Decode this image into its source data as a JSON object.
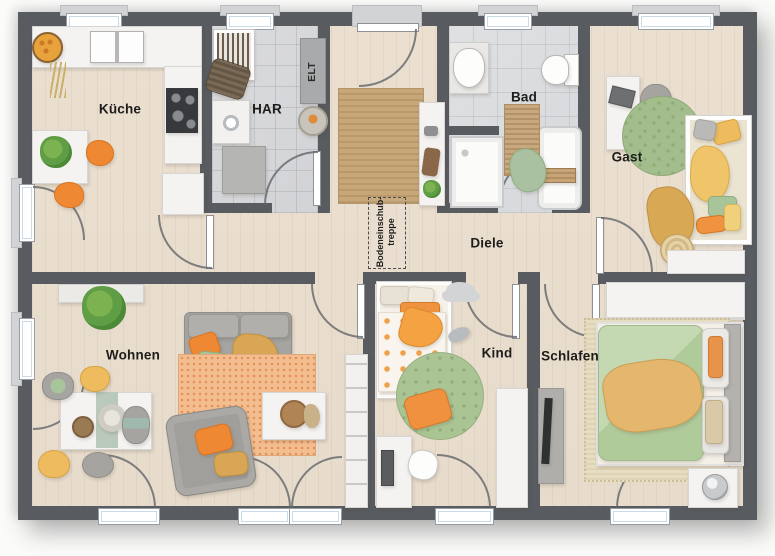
{
  "plan": {
    "type": "floor-plan",
    "rooms": {
      "kueche": {
        "label": "Küche"
      },
      "har": {
        "label": "HAR"
      },
      "elt": {
        "label": "ELT"
      },
      "bad": {
        "label": "Bad"
      },
      "gast": {
        "label": "Gast"
      },
      "diele": {
        "label": "Diele"
      },
      "wohnen": {
        "label": "Wohnen"
      },
      "kind": {
        "label": "Kind"
      },
      "schlafen": {
        "label": "Schlafen"
      }
    },
    "annotations": {
      "loft_ladder": {
        "line1": "Bodeneinschub-",
        "line2": "treppe"
      }
    },
    "colors": {
      "wall": "#585c60",
      "floor_wood": "#e9ddce",
      "floor_tile": "#d6d7d9",
      "rug_jute": "#c7a678",
      "rug_orange": "#f3bd90",
      "rug_green": "#abc494",
      "accent_orange": "#ee8833",
      "accent_green": "#a8c49a",
      "accent_yellow": "#eebc5f",
      "furniture_white": "#f4f3f1"
    }
  }
}
